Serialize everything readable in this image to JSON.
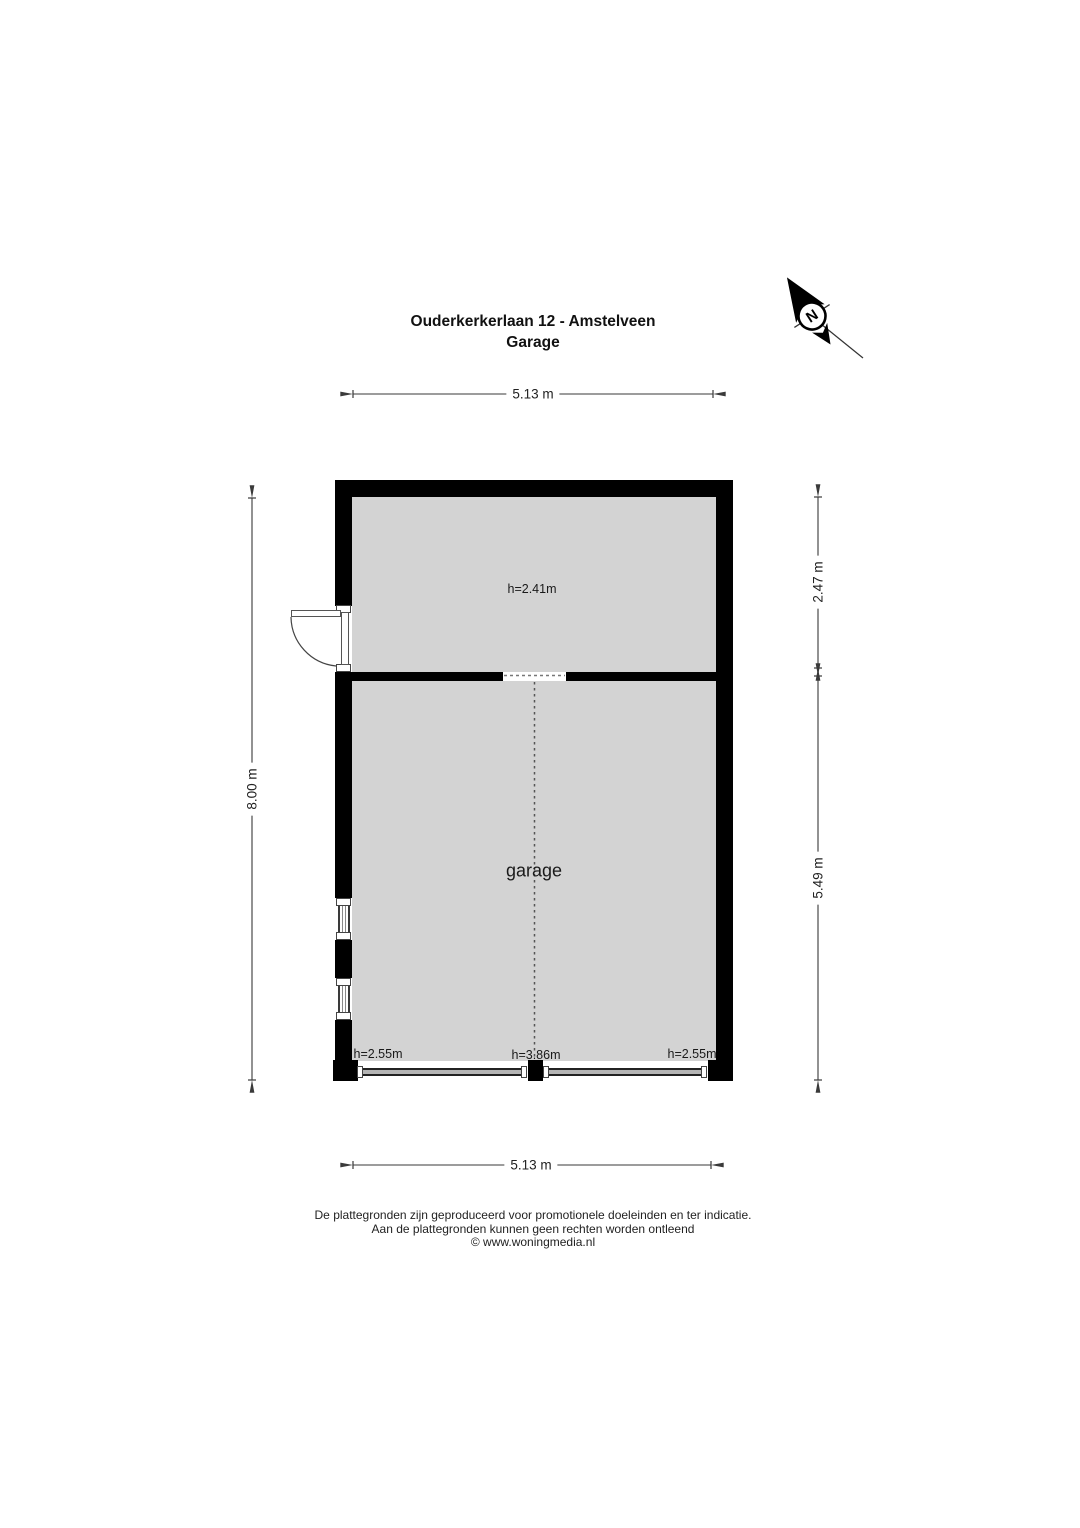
{
  "title": {
    "line1": "Ouderkerkerlaan 12 - Amstelveen",
    "line2": "Garage"
  },
  "compass": {
    "label": "N"
  },
  "dimensions": {
    "top": "5.13 m",
    "bottom": "5.13 m",
    "left": "8.00 m",
    "right_upper": "2.47 m",
    "right_lower": "5.49 m"
  },
  "rooms": {
    "upper": {
      "height_label": "h=2.41m"
    },
    "garage": {
      "name": "garage",
      "height_left": "h=2.55m",
      "height_center": "h=3.86m",
      "height_right": "h=2.55m"
    }
  },
  "footer": {
    "line1": "De plattegronden zijn geproduceerd voor promotionele doeleinden en ter indicatie.",
    "line2": "Aan de plattegronden kunnen geen rechten worden ontleend",
    "line3": "© www.woningmedia.nl"
  },
  "colors": {
    "wall": "#000000",
    "room_fill": "#d3d3d3",
    "dimension_line": "#3a3a3a",
    "detail_line": "#555555"
  }
}
